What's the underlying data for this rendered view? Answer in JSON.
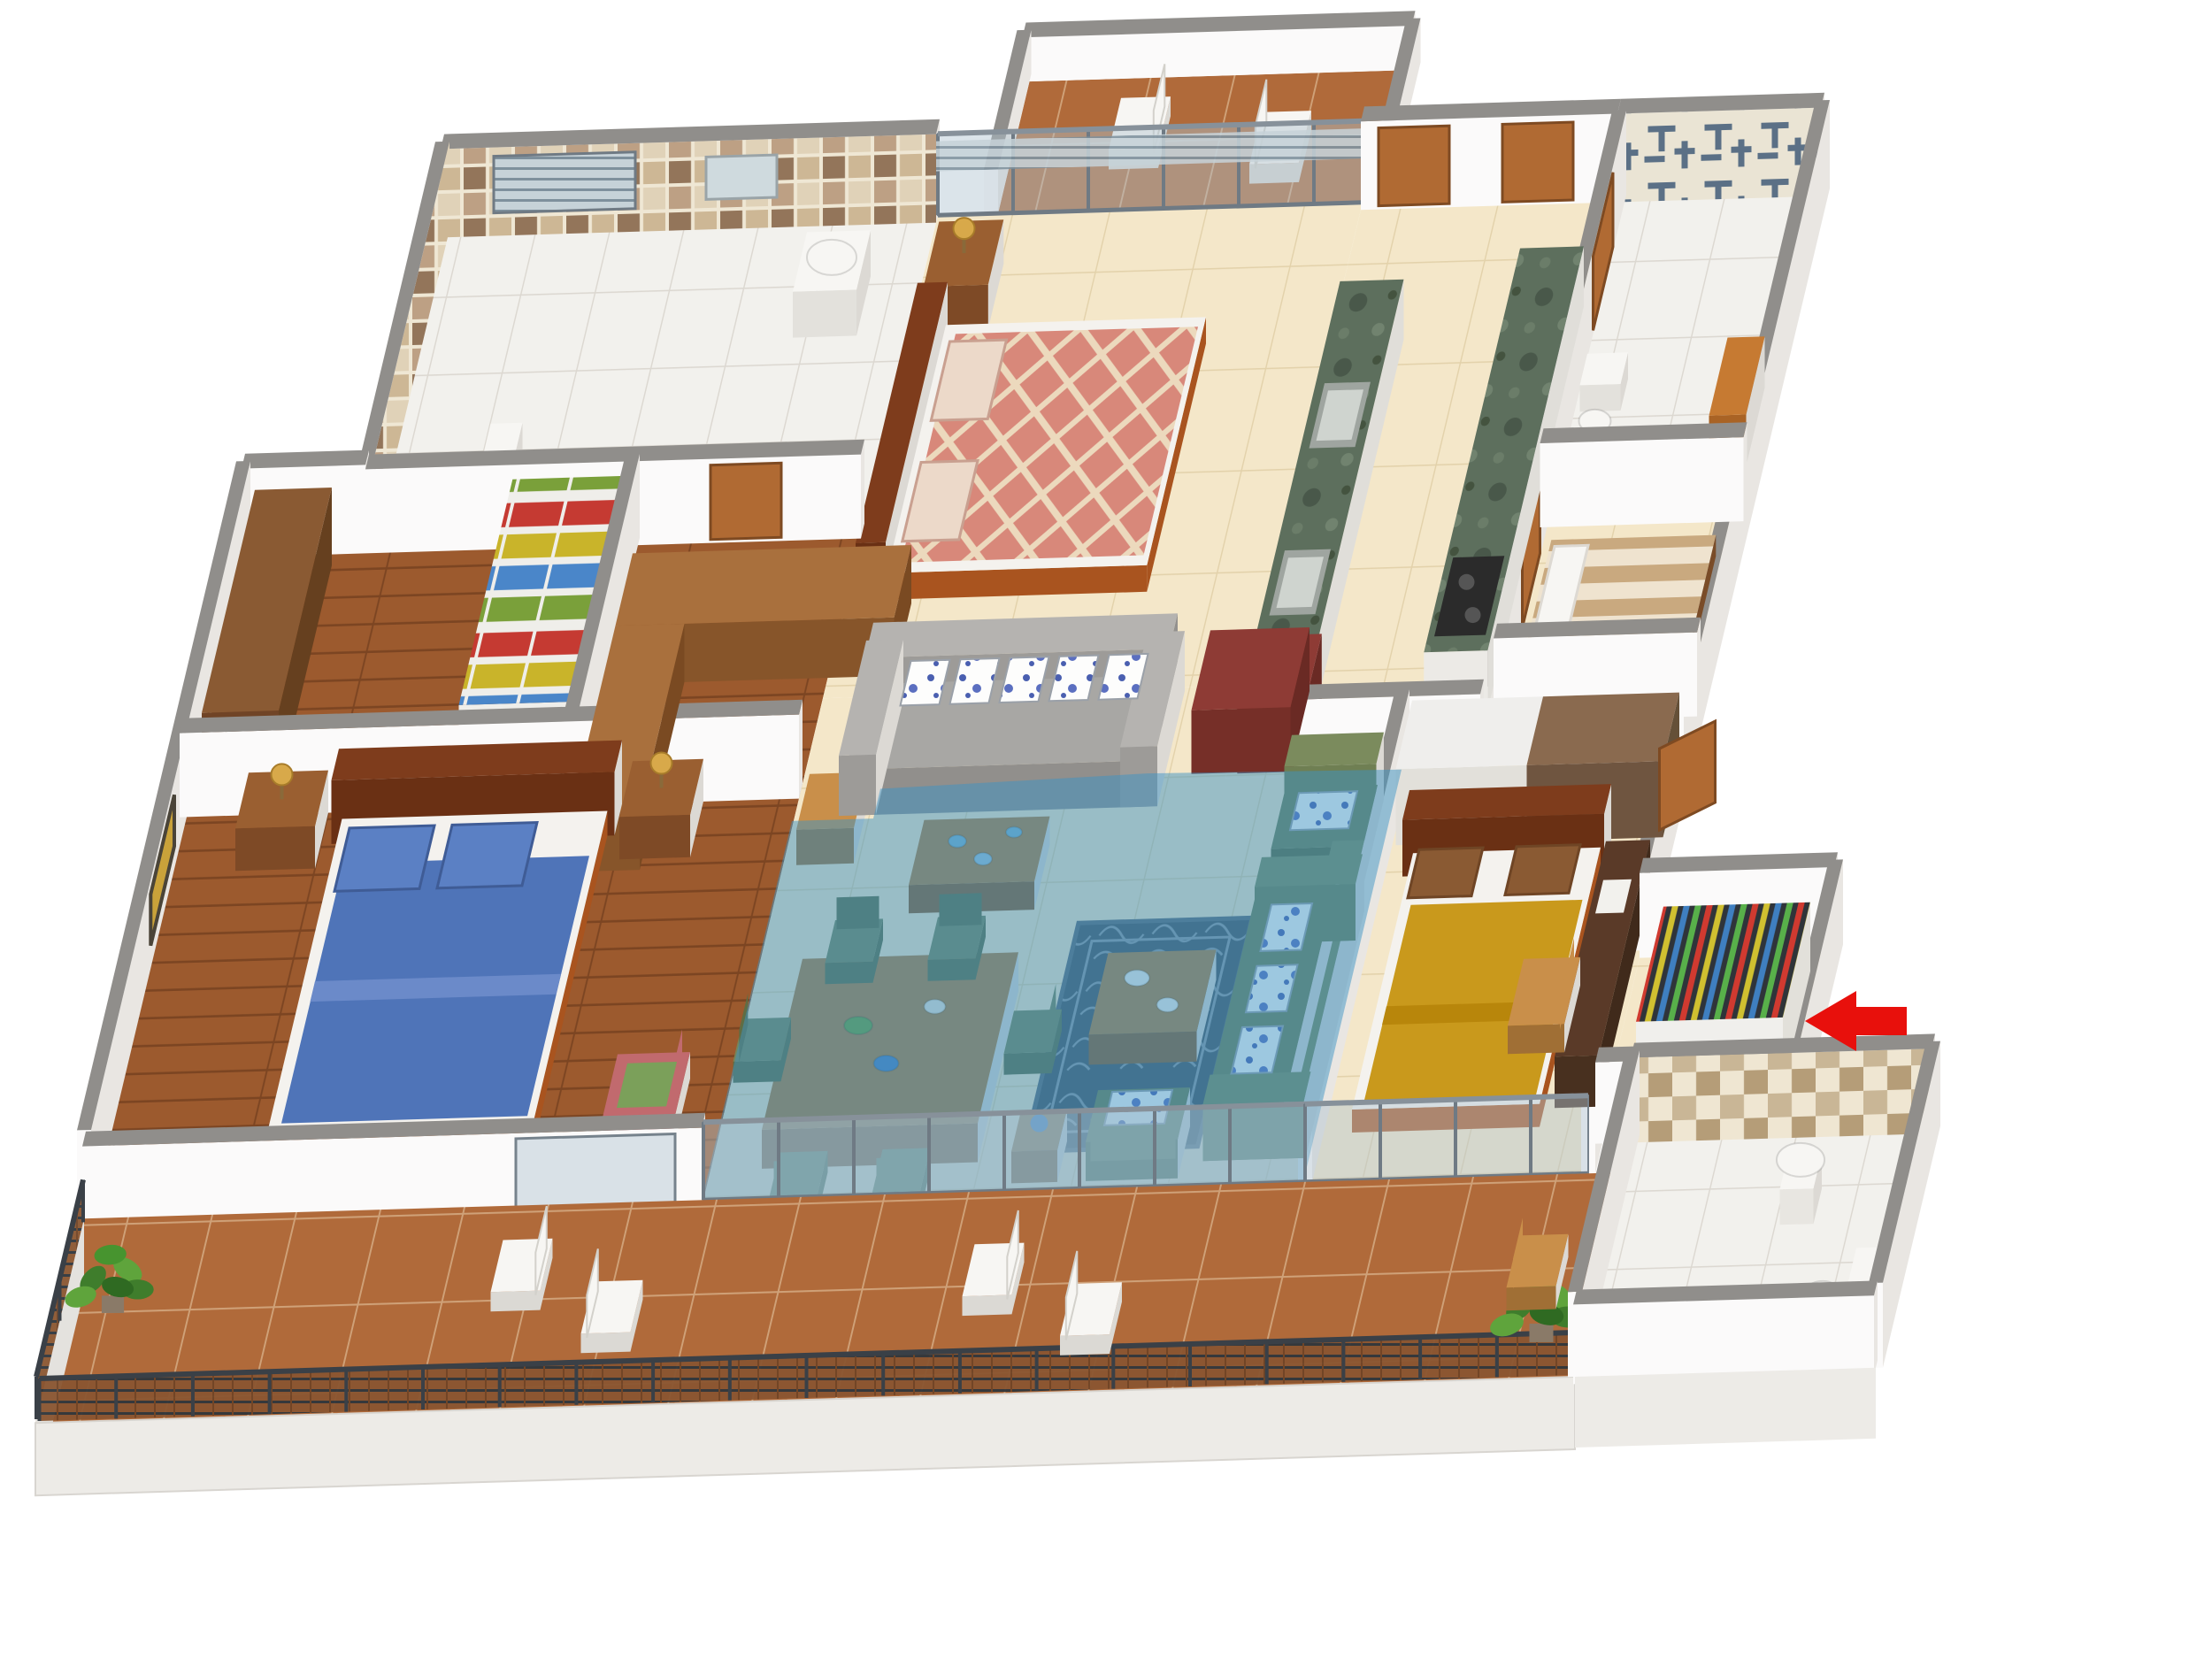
{
  "scene": {
    "title": "3D isometric apartment floor plan render",
    "view": "isometric-3d",
    "highlighted_zone": "living-dining-area",
    "rooms": [
      {
        "name": "bathroom-top-left",
        "floor": "white-tile",
        "features": [
          "toilet",
          "washbasin",
          "louver-window",
          "brown-mosaic-walls"
        ]
      },
      {
        "name": "dressing-area",
        "floor": "wood",
        "features": [
          "wardrobe-with-colorful-clothes",
          "brown-cabinet"
        ]
      },
      {
        "name": "master-bedroom",
        "floor": "wood",
        "features": [
          "blue-double-bed",
          "nightstands-with-gold-lamps",
          "diamond-wall-art",
          "pink-chair"
        ]
      },
      {
        "name": "bedroom-2",
        "floor": "cream-tile",
        "features": [
          "salmon-diamond-pattern-double-bed",
          "nightstand-lamp",
          "glass-wall-to-rear-balcony"
        ]
      },
      {
        "name": "rear-balcony",
        "floor": "terracotta-tile",
        "features": [
          "two-white-chairs"
        ]
      },
      {
        "name": "kitchen",
        "floor": "cream-tile",
        "features": [
          "green-marble-counters",
          "two-sinks",
          "gas-stove",
          "red-cabinet",
          "two-wood-doors"
        ]
      },
      {
        "name": "bathroom-top-right",
        "floor": "white-tile",
        "features": [
          "blue-pattern-tile-wall",
          "toilet",
          "orange-unit"
        ]
      },
      {
        "name": "utility-room",
        "floor": "cream-tile",
        "features": [
          "single-striped-bed"
        ]
      },
      {
        "name": "living-dining-area",
        "floor": "cream-tile",
        "highlighted": true,
        "features": [
          "dining-table-six-green-chairs",
          "gray-sofa-spotted-pillows",
          "green-sofa-set",
          "dark-rug",
          "coffee-tables",
          "red-tv-cabinet"
        ]
      },
      {
        "name": "bedroom-3",
        "floor": "cream-tile",
        "features": [
          "mustard-yellow-double-bed",
          "wardrobe-row",
          "dark-desk",
          "wood-chair"
        ]
      },
      {
        "name": "foyer",
        "floor": "cream-tile",
        "features": [
          "colorful-shoe-rack",
          "open-entrance-door"
        ]
      },
      {
        "name": "bathroom-bottom-right",
        "floor": "white-tile",
        "features": [
          "pedestal-basin",
          "toilet",
          "checkered-mosaic-wall"
        ]
      },
      {
        "name": "front-balcony",
        "floor": "terracotta-tile",
        "features": [
          "metal-railing",
          "four-white-chairs",
          "two-plants",
          "wood-chair"
        ]
      }
    ]
  },
  "annotations": {
    "entrance_arrow": {
      "shape": "left-pointing-arrow",
      "color": "#e8100c"
    }
  },
  "colors": {
    "background": "#ffffff",
    "wallCap": "#908e8b",
    "wallFace": "#fbfafa",
    "wallSide": "#e9e6e2",
    "floorCream": "#f4e7c9",
    "floorWhite": "#f2f1ed",
    "floorWood": "#9c5a2e",
    "floorTerracotta": "#b06a3a",
    "highlight": "#3e93c4",
    "arrowRed": "#e8100c",
    "bedBlue": "#4f74b8",
    "bedSalmon": "#d8887a",
    "bedYellow": "#c9991c",
    "mattress": "#f4f2ee",
    "frameWood": "#a9541f",
    "headboard": "#7e3c1c",
    "sofaGray": "#a8a7a4",
    "sofaGreen": "#6f7f53",
    "chairGreen": "#76855a",
    "counterGreen": "#5d6f5d",
    "cabinetRed": "#8e3b35",
    "woodCounter": "#a9703d",
    "door": "#b06a33",
    "railDark": "#3a4047",
    "glass": "rgba(175,195,208,0.45)",
    "plantGreen": "#4e8f35",
    "lampGold": "#d8a94a"
  }
}
